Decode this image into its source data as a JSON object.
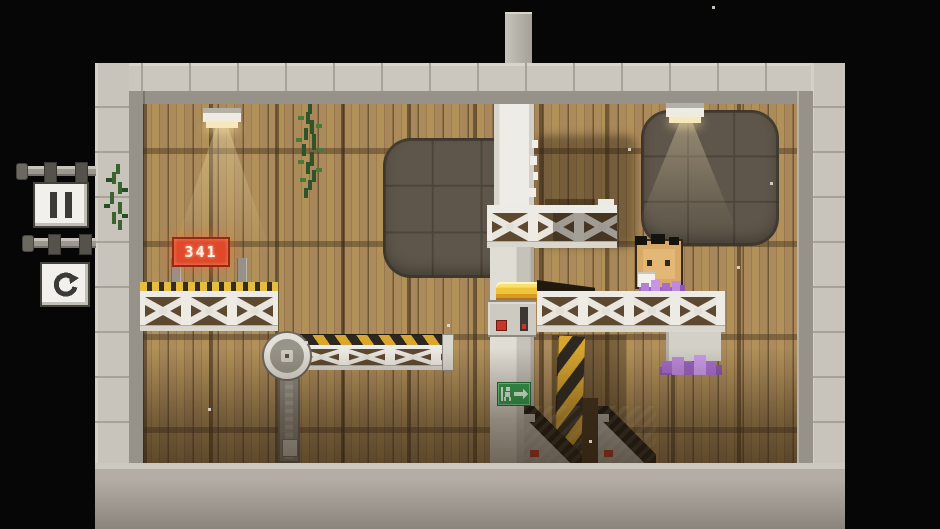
{
  "scene": {
    "name": "pixel factory room",
    "style": "pixel-art platformer level"
  },
  "hud": {
    "pause_button": {
      "icon": "pause-icon"
    },
    "restart_button": {
      "icon": "restart-icon"
    }
  },
  "room": {
    "counter_display": {
      "value": "341"
    },
    "exit_sign": {
      "icon": "exit-running-man-arrow"
    }
  },
  "colors": {
    "background": "#060606",
    "stone_light": "#cbc7be",
    "stone_jamb": "#96928a",
    "wood_mid": "#a5875a",
    "slab_dark": "#5e564a",
    "truss_white": "#e9e6df",
    "hazard_yellow": "#d7a52f",
    "hazard_black": "#2c2720",
    "counter_red": "#e0482a",
    "exit_green": "#2f9e4f",
    "butter_yellow": "#edb92e",
    "crystal_purple": "#bd8ade",
    "character_box": "#d9a968"
  }
}
